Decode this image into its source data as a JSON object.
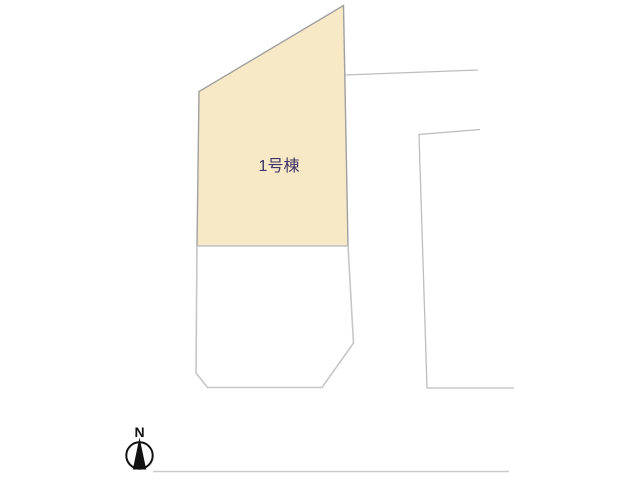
{
  "page": {
    "background": "#ffffff"
  },
  "plan": {
    "lots": [
      {
        "label": "1号棟",
        "fill": "#F8E9C6",
        "stroke": "#A0A0A0",
        "label_color": "#3E3366"
      },
      {
        "fill": "#FFFFFF",
        "stroke": "#C6C6C6"
      }
    ],
    "road_lines": {
      "color": "#BDBDBD"
    },
    "ground_line": {
      "color": "#CBCBCB"
    }
  },
  "compass": {
    "label": "N",
    "color": "#111111"
  }
}
